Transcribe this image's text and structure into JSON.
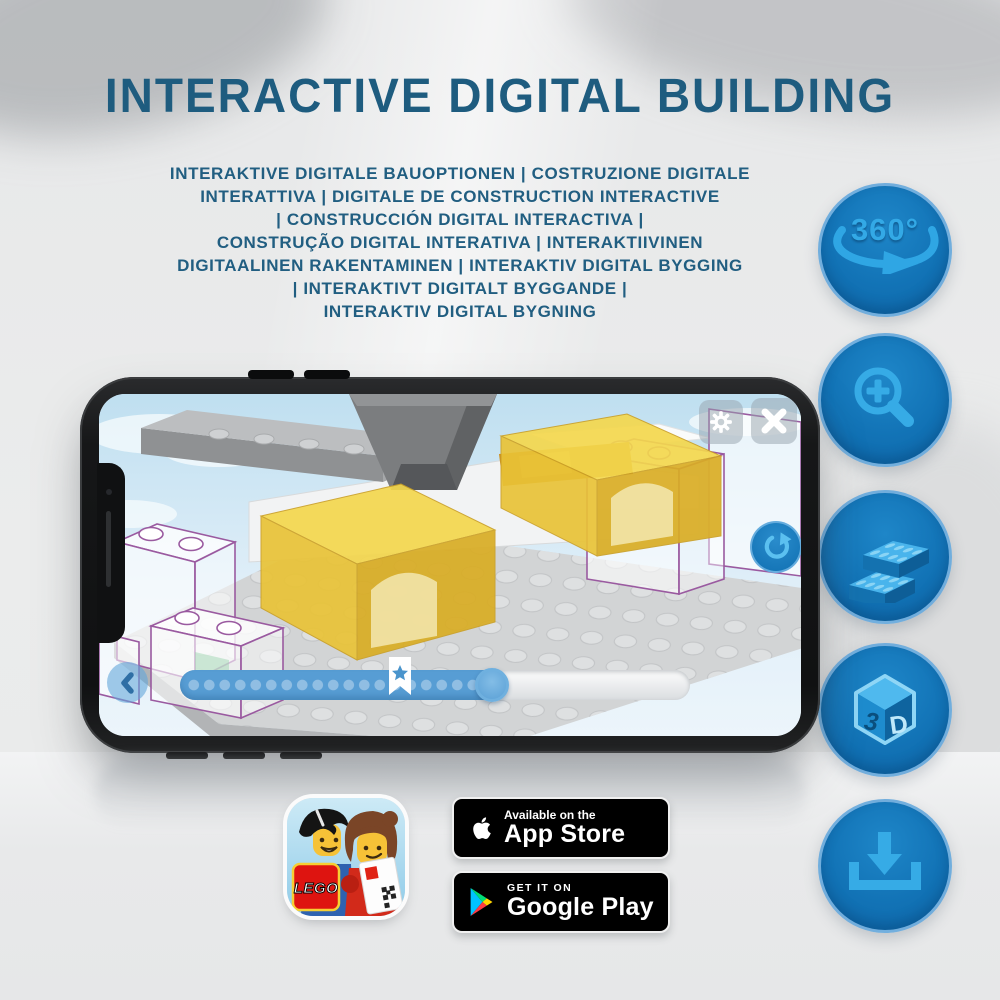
{
  "title": "INTERACTIVE DIGITAL BUILDING",
  "subtitle": {
    "lines": [
      "INTERAKTIVE DIGITALE BAUOPTIONEN | COSTRUZIONE DIGITALE",
      "INTERATTIVA | DIGITALE DE CONSTRUCTION INTERACTIVE",
      "| CONSTRUCCIÓN DIGITAL INTERACTIVA |",
      "CONSTRUÇÃO DIGITAL INTERATIVA | INTERAKTIIVINEN",
      "DIGITAALINEN RAKENTAMINEN | INTERAKTIV DIGITAL BYGGING",
      "| INTERAKTIVT DIGITALT BYGGANDE |",
      "INTERAKTIV DIGITAL BYGNING"
    ]
  },
  "feature_buttons": {
    "rotate_360_label": "360°",
    "cube_letter_1": "3",
    "cube_letter_2": "D"
  },
  "store": {
    "lego_logo": "LEGO",
    "app_store": {
      "tagline": "Available on the",
      "name": "App Store"
    },
    "google_play": {
      "tagline": "GET IT ON",
      "name": "Google Play"
    }
  },
  "colors": {
    "accent_blue": "#1071b5",
    "icon_light_blue": "#35a8e2",
    "title_blue": "#1e5c7f",
    "lego_yellow": "#f0cf3e",
    "ghost_outline_purple": "#9a5aa0"
  }
}
